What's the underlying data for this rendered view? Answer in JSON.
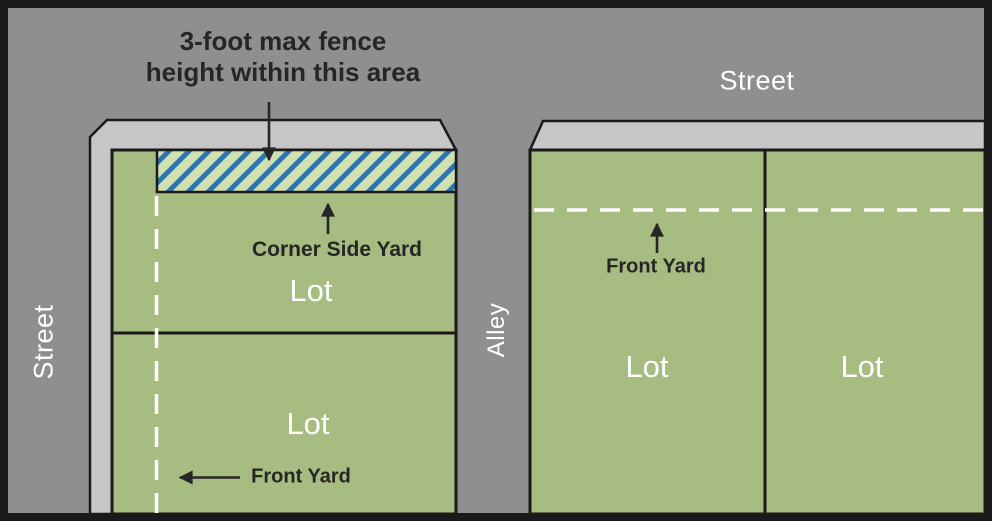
{
  "title": "Fence height zoning diagram",
  "colors": {
    "street": "#8f8f8f",
    "sidewalk": "#c6c6c6",
    "lot": "#a6bc80",
    "hatch_bg": "#d0e0ae",
    "hatch_stripe": "#2e75b0",
    "outline": "#1a1a1a",
    "label_dark": "#262626",
    "label_light": "#ffffff"
  },
  "annotation": {
    "fence_note_line1": "3-foot max fence",
    "fence_note_line2": "height within this area"
  },
  "labels": {
    "street_left": "Street",
    "street_top": "Street",
    "alley": "Alley",
    "corner_side_yard": "Corner Side Yard",
    "front_yard_left": "Front Yard",
    "front_yard_right": "Front Yard"
  },
  "lots": {
    "left_block": [
      "Lot",
      "Lot"
    ],
    "right_block": [
      "Lot",
      "Lot"
    ]
  }
}
